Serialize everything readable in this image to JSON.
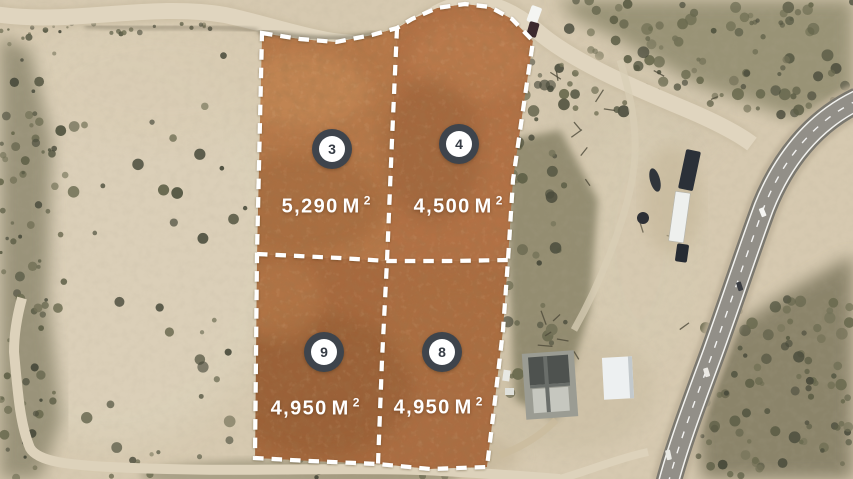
{
  "image_type": "aerial-lot-map",
  "lots": [
    {
      "id": "lot-3",
      "number": "3",
      "area_value": "5,290",
      "area_unit": "M",
      "area_sup": "2"
    },
    {
      "id": "lot-4",
      "number": "4",
      "area_value": "4,500",
      "area_unit": "M",
      "area_sup": "2"
    },
    {
      "id": "lot-9",
      "number": "9",
      "area_value": "4,950",
      "area_unit": "M",
      "area_sup": "2"
    },
    {
      "id": "lot-8",
      "number": "8",
      "area_value": "4,950",
      "area_unit": "M",
      "area_sup": "2"
    }
  ],
  "colors": {
    "boundary_dash": "#ffffff",
    "lot_overlay_top": "#b47449",
    "lot_overlay_bottom": "#a86a3f",
    "badge_ring": "#3e444c",
    "badge_fill": "#ffffff",
    "badge_number": "#353b44",
    "area_label": "#ffffff",
    "desert_sand": "#d6c9b0",
    "scrub_olive": "#6a6a4f",
    "highway_asphalt": "#8b8881"
  }
}
